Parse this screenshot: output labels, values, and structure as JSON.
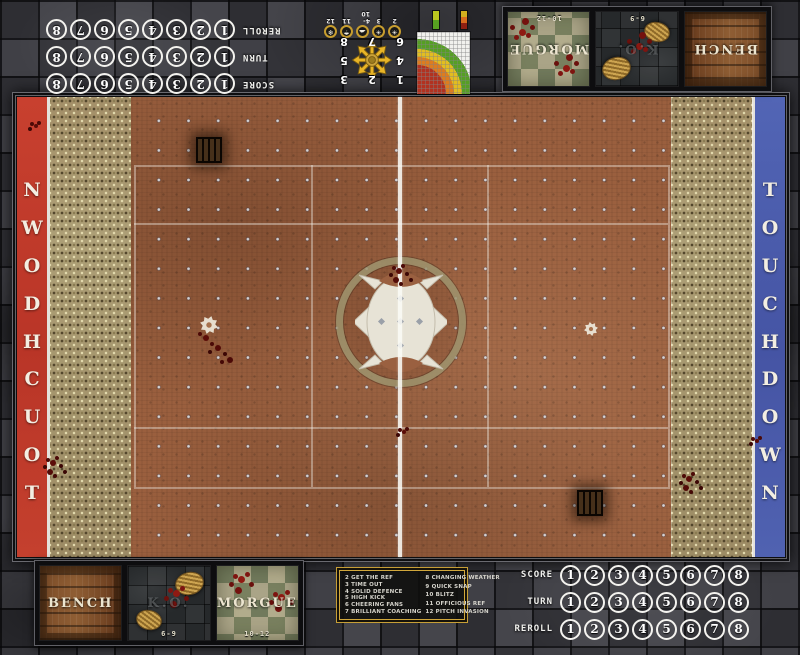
{
  "end_zones": {
    "left_label": "TOUCHDOWN",
    "right_label": "TOUCHDOWN",
    "left_color": "#c13a2b",
    "right_color": "#4d5fae"
  },
  "tracks": {
    "row_labels": [
      "SCORE",
      "TURN",
      "REROLL"
    ],
    "numbers": [
      "1",
      "2",
      "3",
      "4",
      "5",
      "6",
      "7",
      "8"
    ]
  },
  "dugout": {
    "bench_label": "BENCH",
    "ko_label": "K.O.",
    "morgue_label": "MORGUE",
    "ko_range": "6-9",
    "morgue_range": "10-12"
  },
  "kickoff_table": {
    "left_column": [
      "2 GET THE REF",
      "3 TIME OUT",
      "4 SOLID DEFENCE",
      "5 HIGH KICK",
      "6 CHEERING FANS",
      "7 BRILLIANT COACHING"
    ],
    "right_column": [
      "8 CHANGING WEATHER",
      "9 QUICK SNAP",
      "10 BLITZ",
      "11 OFFICIOUS REF",
      "12 PITCH INVASION"
    ]
  },
  "scatter_template": {
    "numbers": [
      "1",
      "2",
      "3",
      "4",
      "5",
      "6",
      "7",
      "8"
    ]
  },
  "weather_table": {
    "entries": [
      {
        "label": "2",
        "glyph": "☀",
        "name": "sweltering-heat-icon"
      },
      {
        "label": "3",
        "glyph": "☀",
        "name": "very-sunny-icon"
      },
      {
        "label": "4-10",
        "glyph": "☁",
        "name": "perfect-conditions-icon"
      },
      {
        "label": "11",
        "glyph": "☂",
        "name": "pouring-rain-icon"
      },
      {
        "label": "12",
        "glyph": "❄",
        "name": "blizzard-icon"
      }
    ]
  }
}
